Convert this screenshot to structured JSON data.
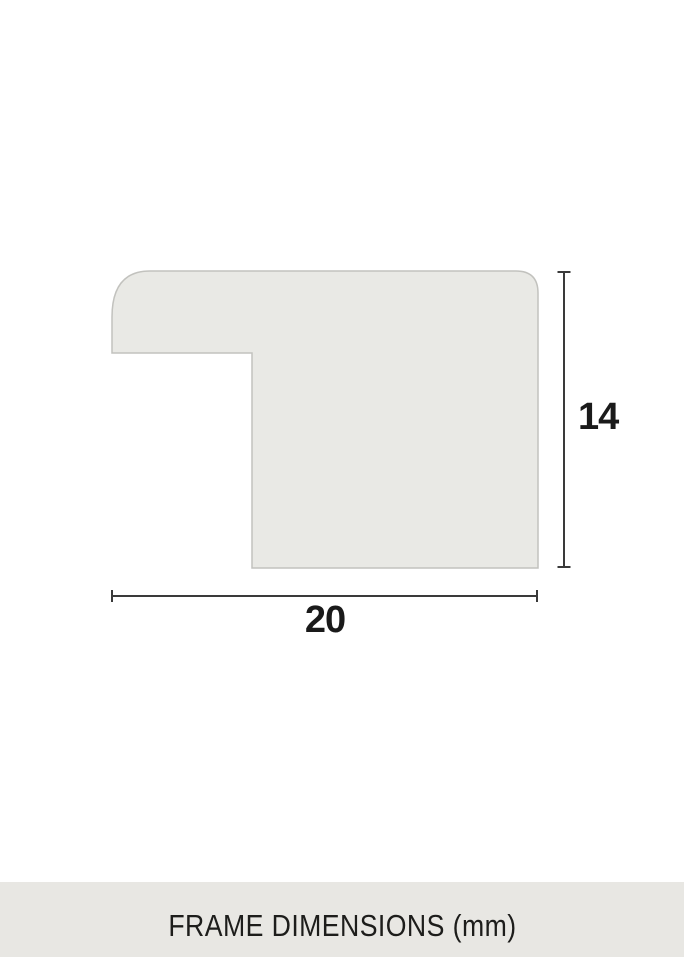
{
  "page": {
    "background": "#ffffff"
  },
  "diagram": {
    "shape": {
      "fill": "#e9e9e5",
      "stroke": "#c2c2be"
    },
    "dimension_lines": {
      "color": "#3a3a3a"
    },
    "dimensions": {
      "height": "14",
      "width": "20"
    },
    "label_color": "#1a1a1a"
  },
  "footer": {
    "title": "FRAME DIMENSIONS (mm)",
    "background": "#e8e7e3",
    "text_color": "#1d1d1b"
  }
}
